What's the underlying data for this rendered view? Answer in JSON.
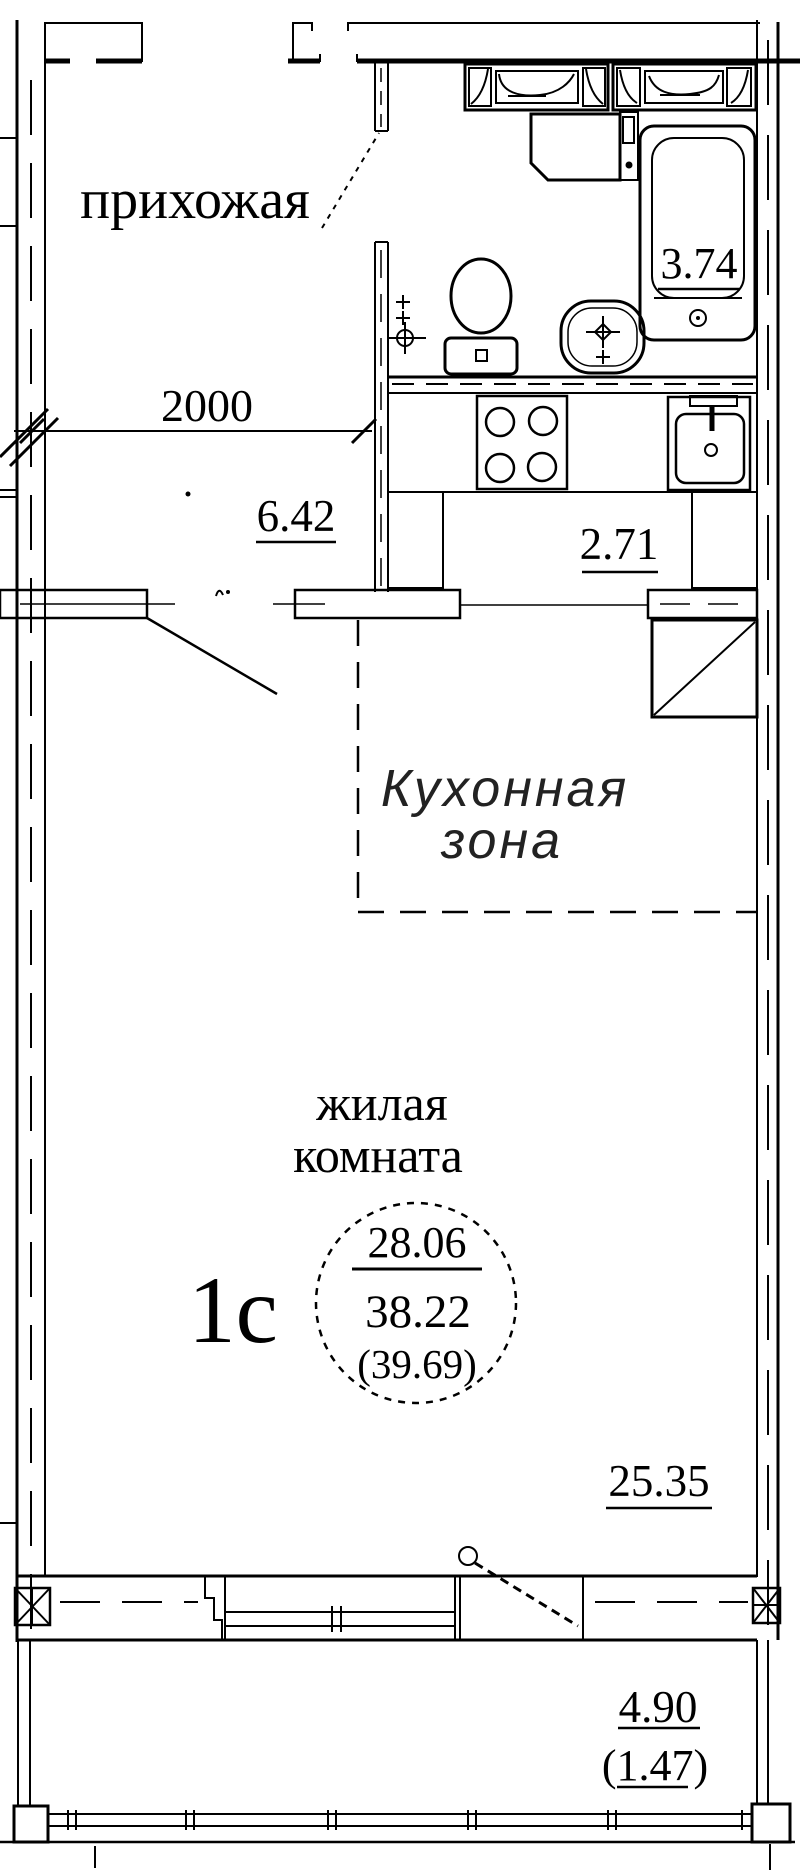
{
  "plan": {
    "type": "apartment-floor-plan",
    "unit": {
      "code": "1с",
      "area_living": "28.06",
      "area_total": "38.22",
      "area_total_with_balcony": "(39.69)"
    },
    "rooms": {
      "hallway": {
        "name": "прихожая",
        "area": "6.42"
      },
      "bathroom": {
        "area": "3.74"
      },
      "kitchen_niche": {
        "area": "2.71"
      },
      "kitchen_zone": {
        "name_line1": "Кухонная",
        "name_line2": "зона"
      },
      "living": {
        "name_line1": "жилая",
        "name_line2": "комната",
        "area": "25.35"
      },
      "balcony": {
        "area": "4.90",
        "area_with_coefficient": "(1.47)"
      }
    },
    "dimensions": {
      "hallway_width_mm": "2000"
    },
    "colors": {
      "ink": "#000000",
      "paper": "#ffffff"
    }
  }
}
